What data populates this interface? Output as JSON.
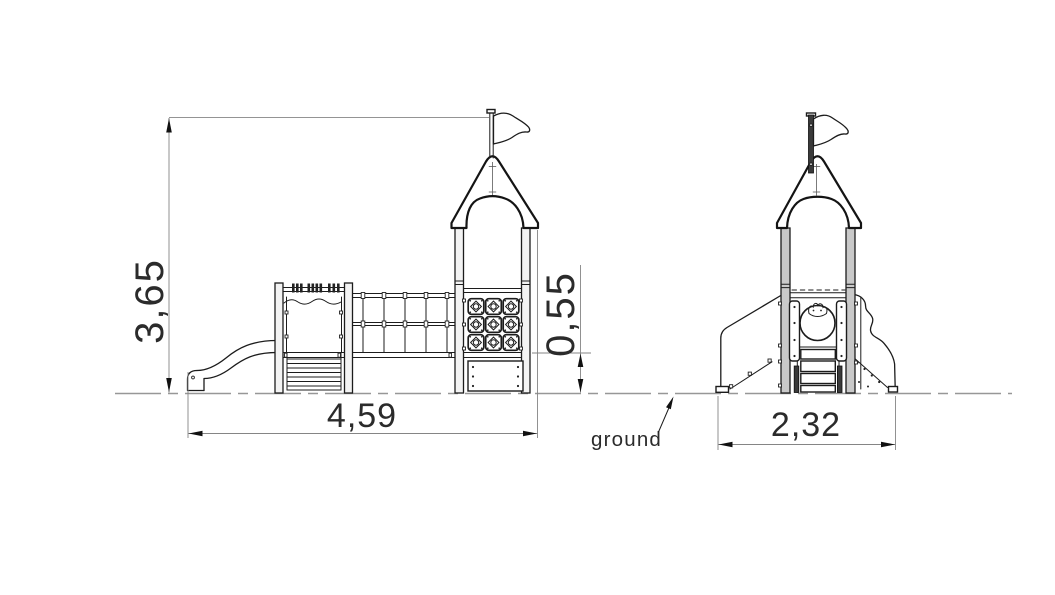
{
  "drawing": {
    "dimensions": {
      "total_height": "3,65",
      "total_length": "4,59",
      "platform_height": "0,55",
      "footprint_width": "2,32"
    },
    "labels": {
      "ground": "ground"
    },
    "parts": [
      "flag-pennant",
      "castle-roof",
      "tower-posts",
      "activity-panel-grid",
      "net-bridge",
      "climbing-steps",
      "slide",
      "porthole-window",
      "side-ramp-panels",
      "ground-line"
    ],
    "colors": {
      "background": "#ffffff",
      "line": "#1c1c1c",
      "dimension": "#858585",
      "text": "#2b2b2b"
    }
  }
}
